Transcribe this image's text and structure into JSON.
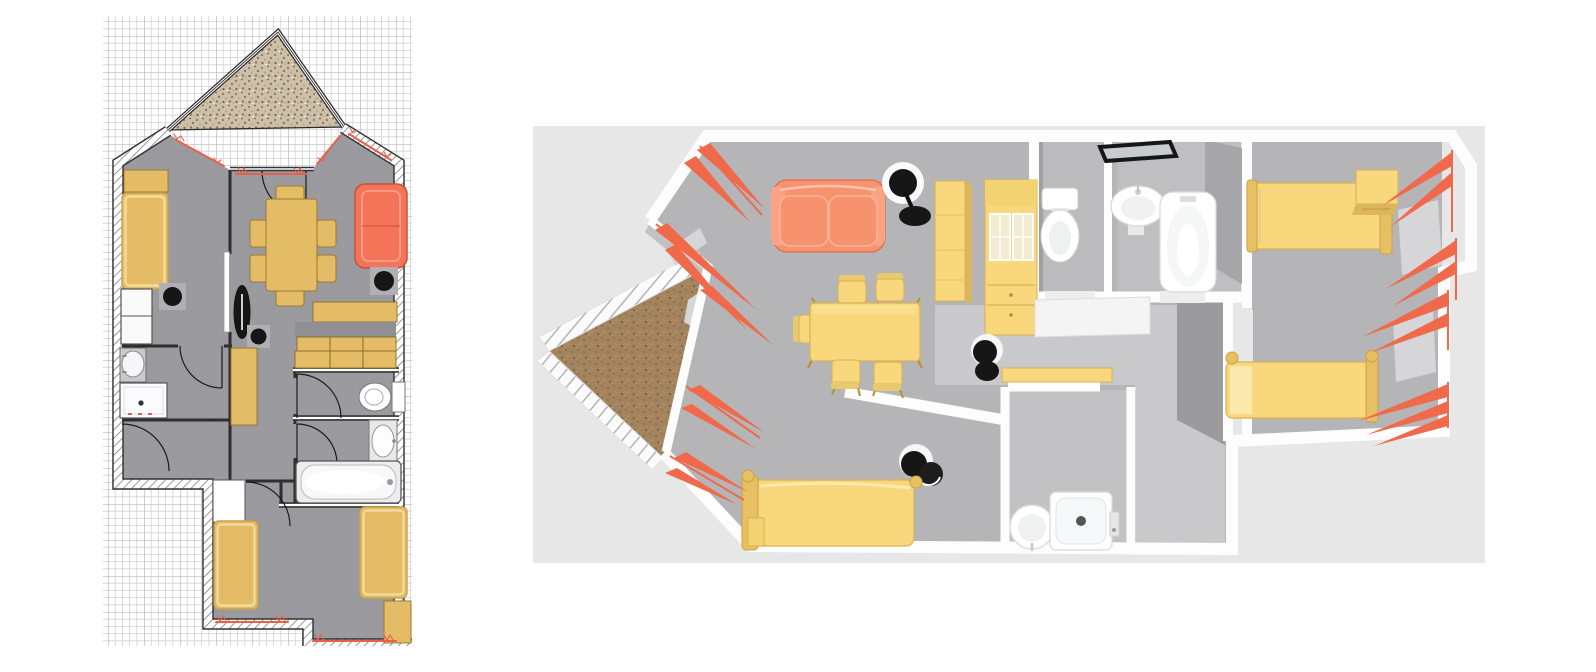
{
  "workspace": {
    "name": "home-plan-workspace",
    "description": "Split workspace of a home design app: 2D blueprint floor plan on grid paper at left, 3D aerial render of the same apartment at right",
    "panels": [
      {
        "id": "plan2d",
        "label": "2D floor plan",
        "type": "blueprint-canvas"
      },
      {
        "id": "view3d",
        "label": "3D aerial view",
        "type": "render-canvas"
      }
    ]
  },
  "palette": {
    "bg3d": "#e7e7e7",
    "gridMinor": "#d2d2d4",
    "gridMajor": "#a9a9ad",
    "floor2d": "#9b9b9f",
    "floorGrid2d": "#8f8f94",
    "wallLine": "#2e2e2e",
    "hatch": "#6e6e6e",
    "yellow2d": "#e4bc66",
    "yellowEdge2d": "#9a7a30",
    "yellowLight2d": "#f2dca0",
    "sofa2d": "#f4745a",
    "sofaEdge2d": "#c2533c",
    "curtain2d": "#e8604a",
    "black": "#161616",
    "graybox2d": "#b0b0b4",
    "fixture": "#f6f6f8",
    "fixtureEdge": "#777777",
    "speckleBase": "#cdbfa8",
    "speckleDot": "#8a7a60",
    "balcony3d": "#a3845f",
    "balconyDot3d": "#8a6c4a",
    "floor3d": "#b5b5b8",
    "corridor3d": "#c9c9cc",
    "wall3d": "#fdfdfd",
    "wallFace3d": "#9b9b9e",
    "yellow3d": "#f8d77d",
    "yellow3dEdge": "#d9b254",
    "yellow3dDark": "#caa348",
    "sofa3d": "#f7926f",
    "sofa3dEdge": "#e06a48",
    "curtain3d": "#f0694b",
    "pane3d": "#d6d6d9",
    "white3d": "#f2f2f4"
  },
  "plan2d": {
    "rooms": [
      "balcony-terrace",
      "living-dining",
      "bedroom-left",
      "shower-room",
      "hallway",
      "kitchen",
      "wc",
      "bathroom",
      "entry",
      "bedroom-bottom"
    ],
    "furniture": [
      "wardrobe-top-left",
      "single-bed-left",
      "closet-white",
      "stool-bedroom",
      "floor-lamp",
      "stool-hall",
      "dining-table",
      "dining-chairs-x6",
      "sofa",
      "side-stool-living",
      "kitchen-upper-shelf",
      "kitchen-base-cabinets",
      "hall-cabinet",
      "washbasin-shower-room",
      "shower-tray",
      "toilet",
      "bathroom-washbasin",
      "bathtub",
      "entry-door-leaf",
      "single-bed-bottom-left",
      "single-bed-bottom-right",
      "chest-bottom-right"
    ],
    "window_curtain_marks": 6,
    "door_arcs": 7
  },
  "view3d": {
    "rooms": [
      "balcony-terrace",
      "living-dining-kitchen",
      "wc",
      "bathroom",
      "bedroom-right",
      "corridor",
      "shower-room",
      "bedroom-bottom"
    ],
    "furniture": [
      "sofa",
      "floor-lamp",
      "tall-cabinet",
      "kitchen-glass-cabinet",
      "dining-table",
      "dining-chairs-x5",
      "bar-stool",
      "stool-pair",
      "toilet",
      "wall-mirror",
      "pedestal-washbasin",
      "bathtub",
      "bed-right-top",
      "nightstand",
      "bed-right-bottom",
      "bed-bottom",
      "step-stool",
      "shower-washbasin",
      "shower-tray",
      "wall-shelf"
    ],
    "curtain_clusters": 9,
    "railing": "balcony-railing-striped"
  }
}
